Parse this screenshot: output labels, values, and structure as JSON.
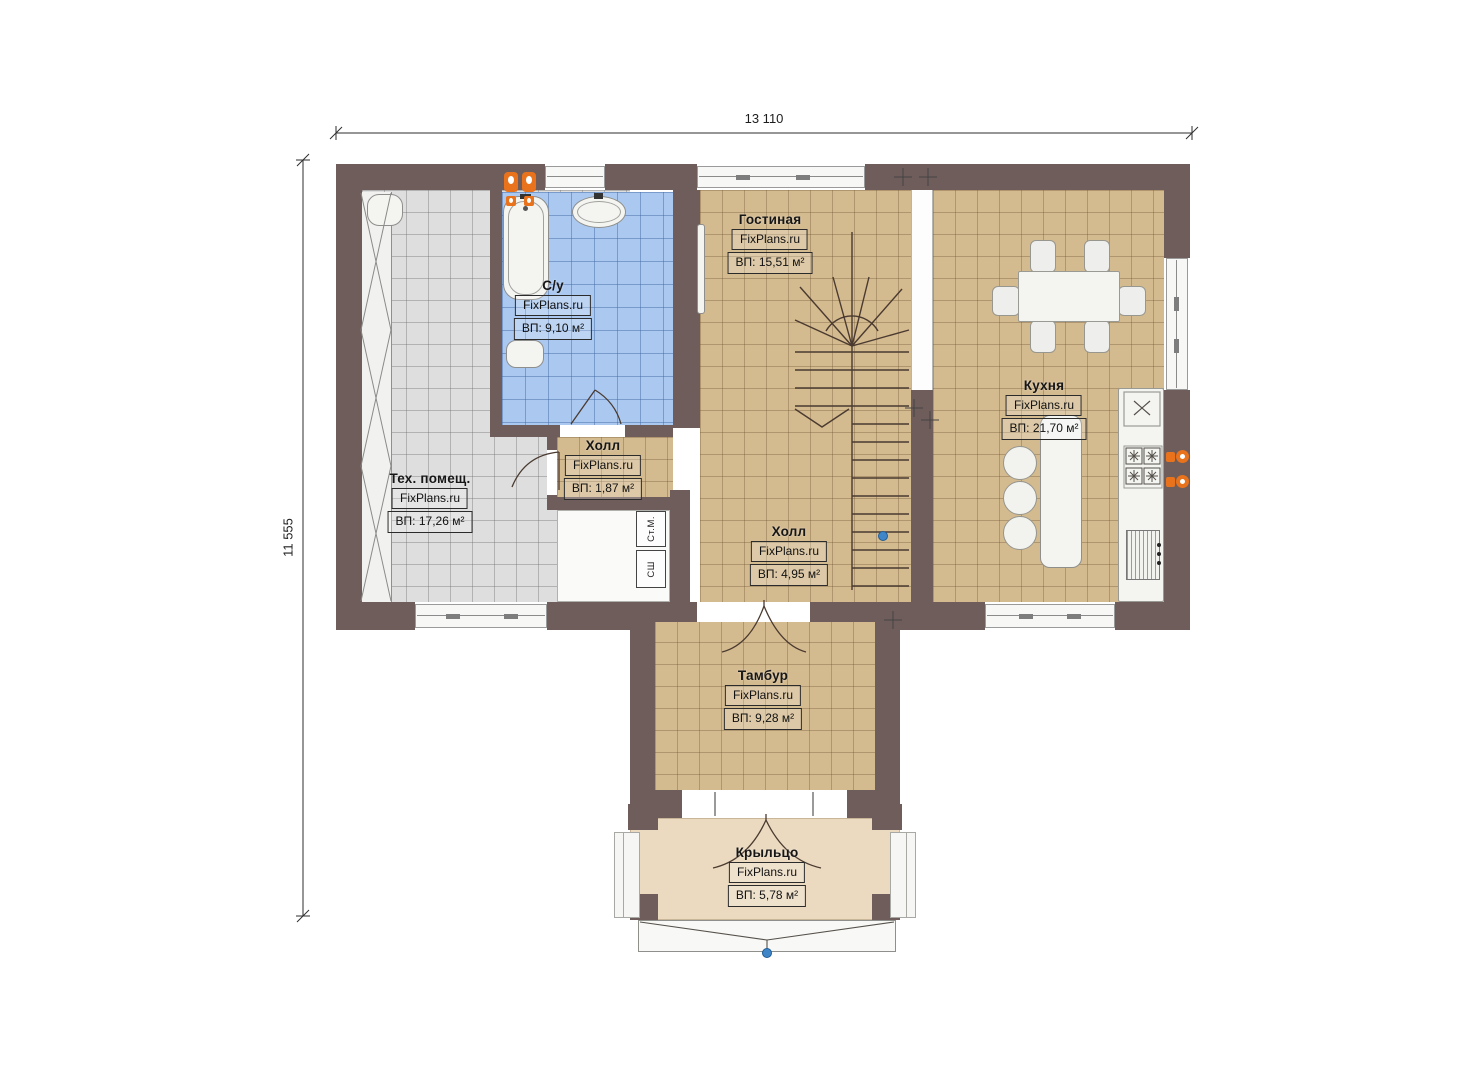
{
  "watermark": "FixPlans.ru",
  "dimensions": {
    "width": "13 110",
    "height": "11 555"
  },
  "rooms": [
    {
      "id": "living",
      "name": "Гостиная",
      "watermark": "FixPlans.ru",
      "area": "ВП: 15,51 м²"
    },
    {
      "id": "bathroom",
      "name": "С/у",
      "watermark": "FixPlans.ru",
      "area": "ВП: 9,10 м²"
    },
    {
      "id": "tech-room",
      "name": "Тех. помещ.",
      "watermark": "FixPlans.ru",
      "area": "ВП: 17,26 м²"
    },
    {
      "id": "hall-small",
      "name": "Холл",
      "watermark": "FixPlans.ru",
      "area": "ВП: 1,87 м²"
    },
    {
      "id": "hall",
      "name": "Холл",
      "watermark": "FixPlans.ru",
      "area": "ВП: 4,95 м²"
    },
    {
      "id": "kitchen",
      "name": "Кухня",
      "watermark": "FixPlans.ru",
      "area": "ВП: 21,70 м²"
    },
    {
      "id": "vestibule",
      "name": "Тамбур",
      "watermark": "FixPlans.ru",
      "area": "ВП: 9,28 м²"
    },
    {
      "id": "porch",
      "name": "Крыльцо",
      "watermark": "FixPlans.ru",
      "area": "ВП: 5,78 м²"
    }
  ],
  "appliances": {
    "washing_machine": "Ст.М.",
    "drying_cabinet": "СШ"
  },
  "colors": {
    "wall": "#6f5d5c",
    "floor_tan": "#d4ba8f",
    "floor_gray": "#dedede",
    "floor_blue": "#abc9f0",
    "floor_porch": "#ebdabf",
    "accent_orange": "#e8731c",
    "marker_blue": "#3f86c9"
  }
}
